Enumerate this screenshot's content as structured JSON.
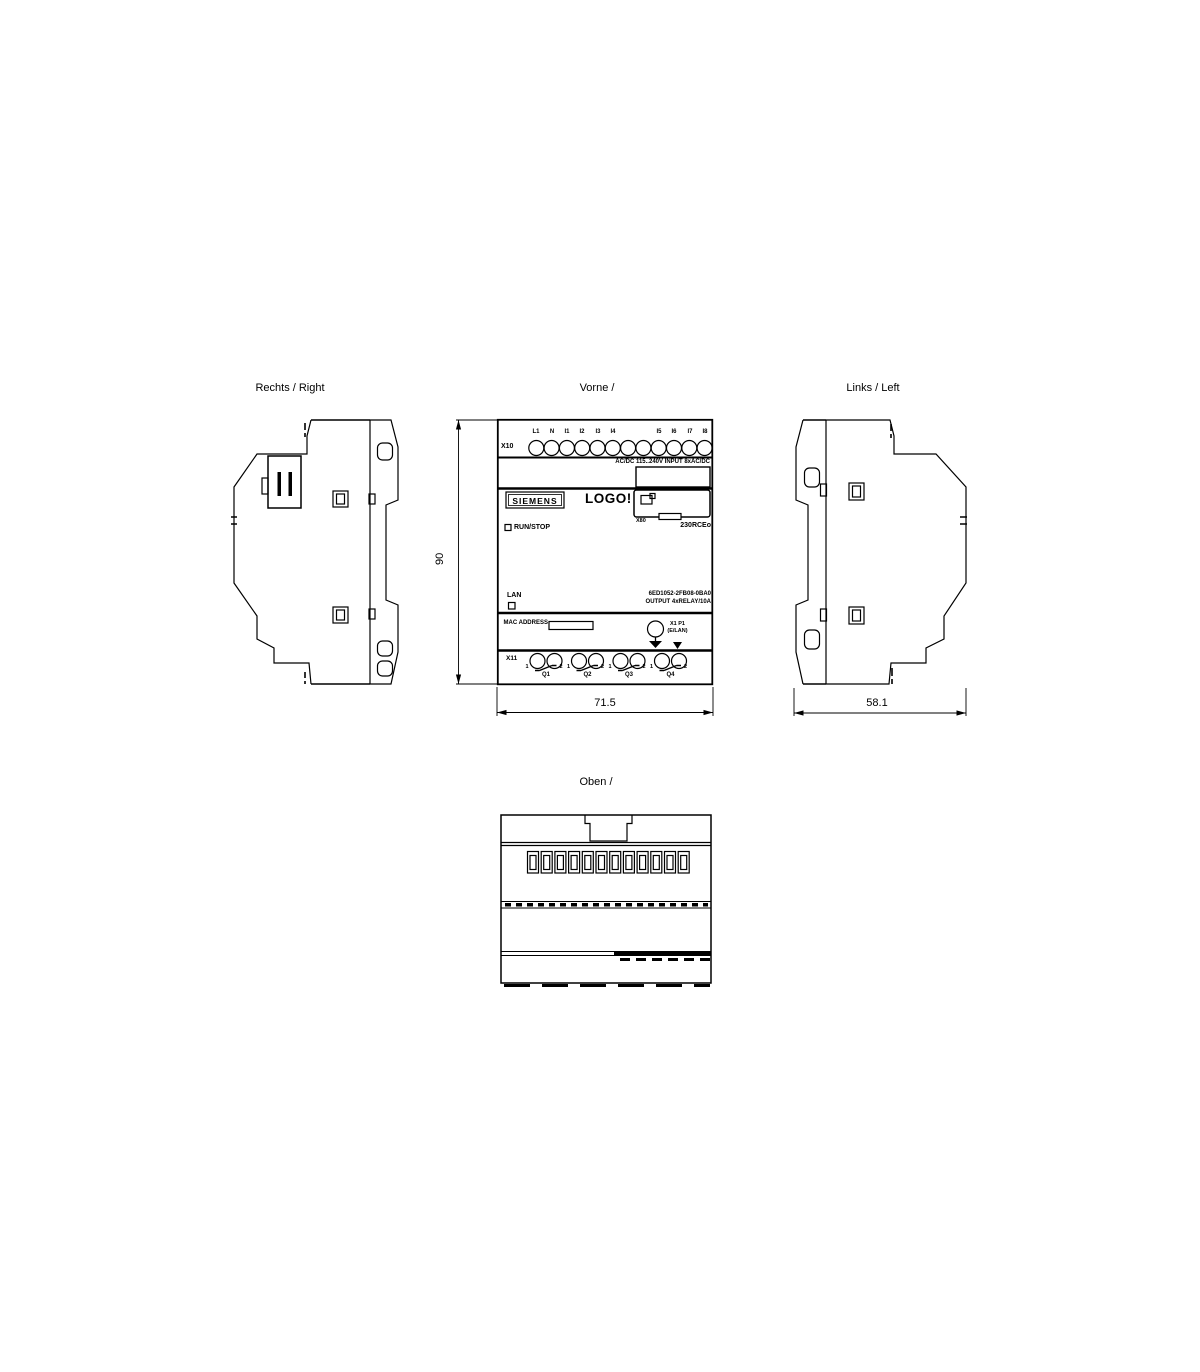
{
  "page": {
    "background": "#ffffff",
    "line_color": "#000000"
  },
  "views": {
    "right": {
      "title": "Rechts / Right"
    },
    "front": {
      "title": "Vorne /"
    },
    "left": {
      "title": "Links / Left"
    },
    "top": {
      "title": "Oben /"
    }
  },
  "dimensions": {
    "height": "90",
    "width": "71.5",
    "depth": "58.1"
  },
  "front": {
    "top_connector": "X10",
    "top_terminals": [
      "L1",
      "N",
      "I1",
      "I2",
      "I3",
      "I4",
      "I5",
      "I6",
      "I7",
      "I8"
    ],
    "input_rating": "AC/DC 115..240V INPUT 8xAC/DC",
    "brand": "SIEMENS",
    "product": "LOGO!",
    "display_connector": "X80",
    "run_stop": "RUN/STOP",
    "model": "230RCEo",
    "lan": "LAN",
    "article_number": "6ED1052-2FB08-0BA0",
    "output_rating": "OUTPUT 4xRELAY/10A",
    "mac_address": "MAC ADDRESS",
    "port_label": "X1 P1",
    "port_sub_label": "(E/LAN)",
    "bottom_connector": "X11",
    "output_terminals": [
      "Q1",
      "Q2",
      "Q3",
      "Q4"
    ],
    "terminal_numbers": [
      "1",
      "2"
    ]
  }
}
